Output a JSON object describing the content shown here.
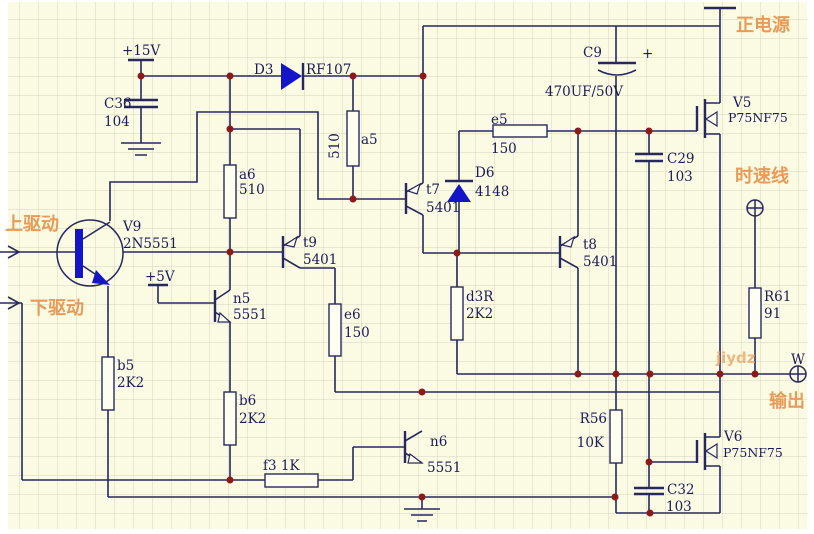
{
  "meta": {
    "type": "circuit-schematic",
    "description": "MOSFET half-bridge driver schematic on grid paper"
  },
  "colors": {
    "paper": "#fbfbe4",
    "grid": "#d5d5bf",
    "wire": "#28285e",
    "blue_fill": "#1414c8",
    "junction_dot": "#8b1a1a",
    "accent_orange": "#e89b58"
  },
  "power": {
    "p15": "+15V",
    "p5": "+5V",
    "pos_supply": "正电源",
    "tach_line": "时速线",
    "output": "输出",
    "w_terminal": "W",
    "upper_drive": "上驱动",
    "lower_drive": "下驱动",
    "watermark": "jiydz"
  },
  "c": {
    "c36": {
      "r": "C36",
      "v": "104"
    },
    "d3": {
      "r": "D3",
      "v": "RF107"
    },
    "a5": {
      "r": "a5",
      "v": "510"
    },
    "a6": {
      "r": "a6",
      "v": "510"
    },
    "c9": {
      "r": "C9",
      "v": "470UF/50V",
      "plus": "+"
    },
    "e5": {
      "r": "e5",
      "v": "150"
    },
    "d6": {
      "r": "D6",
      "v": "4148"
    },
    "t7": {
      "r": "t7",
      "v": "5401"
    },
    "t8": {
      "r": "t8",
      "v": "5401"
    },
    "t9": {
      "r": "t9",
      "v": "5401"
    },
    "v9": {
      "r": "V9",
      "v": "2N5551"
    },
    "n5": {
      "r": "n5",
      "v": "5551"
    },
    "n6": {
      "r": "n6",
      "v": "5551"
    },
    "e6": {
      "r": "e6",
      "v": "150"
    },
    "d3r": {
      "r": "d3R",
      "v": "2K2"
    },
    "b5": {
      "r": "b5",
      "v": "2K2"
    },
    "b6": {
      "r": "b6",
      "v": "2K2"
    },
    "f3": {
      "r": "f3 1K"
    },
    "r56": {
      "r": "R56",
      "v": "10K"
    },
    "r61": {
      "r": "R61",
      "v": "91"
    },
    "c29": {
      "r": "C29",
      "v": "103"
    },
    "c32": {
      "r": "C32",
      "v": "103"
    },
    "v5": {
      "r": "V5",
      "v": "P75NF75"
    },
    "v6": {
      "r": "V6",
      "v": "P75NF75"
    }
  }
}
